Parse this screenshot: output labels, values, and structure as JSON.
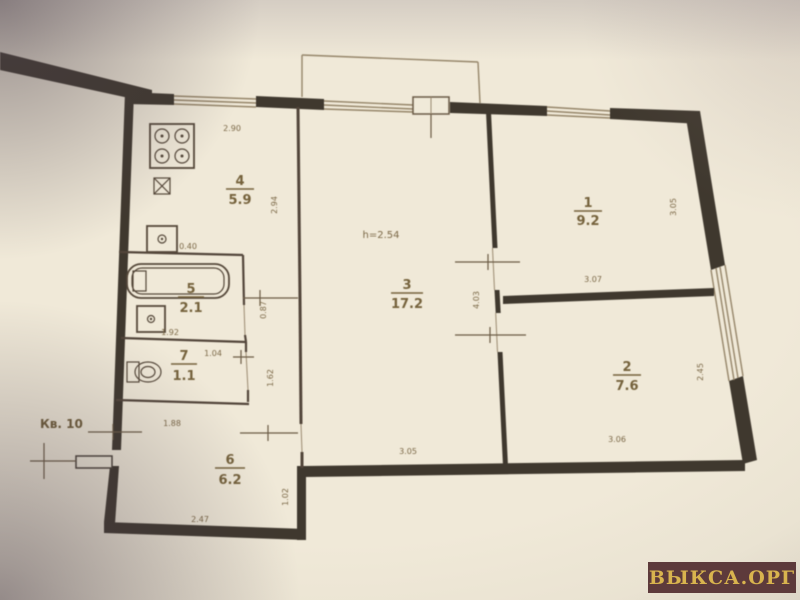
{
  "photo": {
    "watermark": "ВЫКСА.ОРГ",
    "apartment_label": "Кв. 10",
    "ceiling_height": "h=2.54"
  },
  "rooms": [
    {
      "num": "1",
      "area": "9.2"
    },
    {
      "num": "2",
      "area": "7.6"
    },
    {
      "num": "3",
      "area": "17.2"
    },
    {
      "num": "4",
      "area": "5.9"
    },
    {
      "num": "5",
      "area": "2.1"
    },
    {
      "num": "6",
      "area": "6.2"
    },
    {
      "num": "7",
      "area": "1.1"
    }
  ],
  "dims": {
    "kitchen_top": "2.90",
    "kitchen_side": "2.94",
    "sink": "0.40",
    "bath_width": "1.92",
    "wc_width": "1.04",
    "hall_gap_a": "0.87",
    "hall_gap_b": "1.62",
    "hall_top": "1.88",
    "hall_bottom": "2.47",
    "hall_side": "1.02",
    "room3_bottom": "3.05",
    "room3_wall": "4.03",
    "room2_bottom": "3.06",
    "room1_bottom": "3.07",
    "room1_side": "3.05",
    "room2_side": "2.45"
  }
}
